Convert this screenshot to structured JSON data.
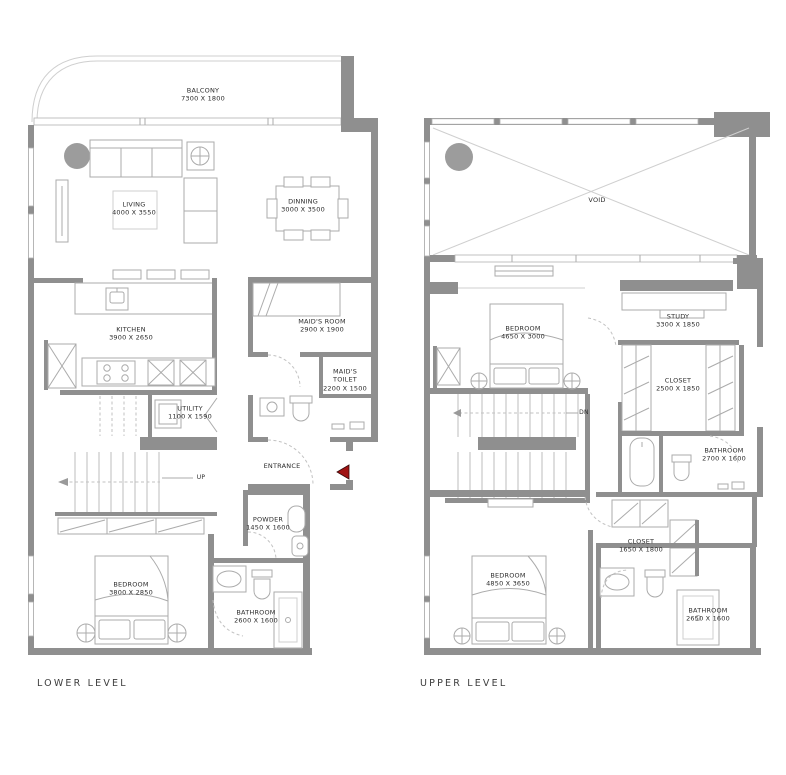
{
  "levels": {
    "lower": {
      "caption": "LOWER LEVEL",
      "rooms": {
        "balcony": {
          "name": "BALCONY",
          "dims": "7300 X 1800"
        },
        "living": {
          "name": "LIVING",
          "dims": "4000 X 3550"
        },
        "dining": {
          "name": "DINNING",
          "dims": "3000 X 3500"
        },
        "kitchen": {
          "name": "KITCHEN",
          "dims": "3900 X 2650"
        },
        "maids_room": {
          "name": "MAID'S ROOM",
          "dims": "2900 X 1900"
        },
        "maids_toilet": {
          "name": "MAID'S TOILET",
          "dims": "2200 X 1500"
        },
        "utility": {
          "name": "UTILITY",
          "dims": "1100 X 1590"
        },
        "entrance": {
          "name": "ENTRANCE",
          "dims": ""
        },
        "powder": {
          "name": "POWDER",
          "dims": "1450 X 1600"
        },
        "bedroom": {
          "name": "BEDROOM",
          "dims": "3800 X 2850"
        },
        "bathroom": {
          "name": "BATHROOM",
          "dims": "2600 X 1600"
        },
        "stairs": {
          "name": "UP",
          "dims": ""
        }
      }
    },
    "upper": {
      "caption": "UPPER LEVEL",
      "rooms": {
        "void": {
          "name": "VOID",
          "dims": ""
        },
        "bedroom1": {
          "name": "BEDROOM",
          "dims": "4650 X 3000"
        },
        "study": {
          "name": "STUDY",
          "dims": "3300 X 1850"
        },
        "closet1": {
          "name": "CLOSET",
          "dims": "2500 X 1850"
        },
        "bathroom1": {
          "name": "BATHROOM",
          "dims": "2700 X 1600"
        },
        "stairs": {
          "name": "DN",
          "dims": ""
        },
        "closet2": {
          "name": "CLOSET",
          "dims": "1650 X 1800"
        },
        "bedroom2": {
          "name": "BEDROOM",
          "dims": "4850 X 3650"
        },
        "bathroom2": {
          "name": "BATHROOM",
          "dims": "2650 X 1600"
        }
      }
    }
  },
  "colors": {
    "wall_gray": "#8f8f8f",
    "entrance_arrow_red": "#a01212"
  }
}
